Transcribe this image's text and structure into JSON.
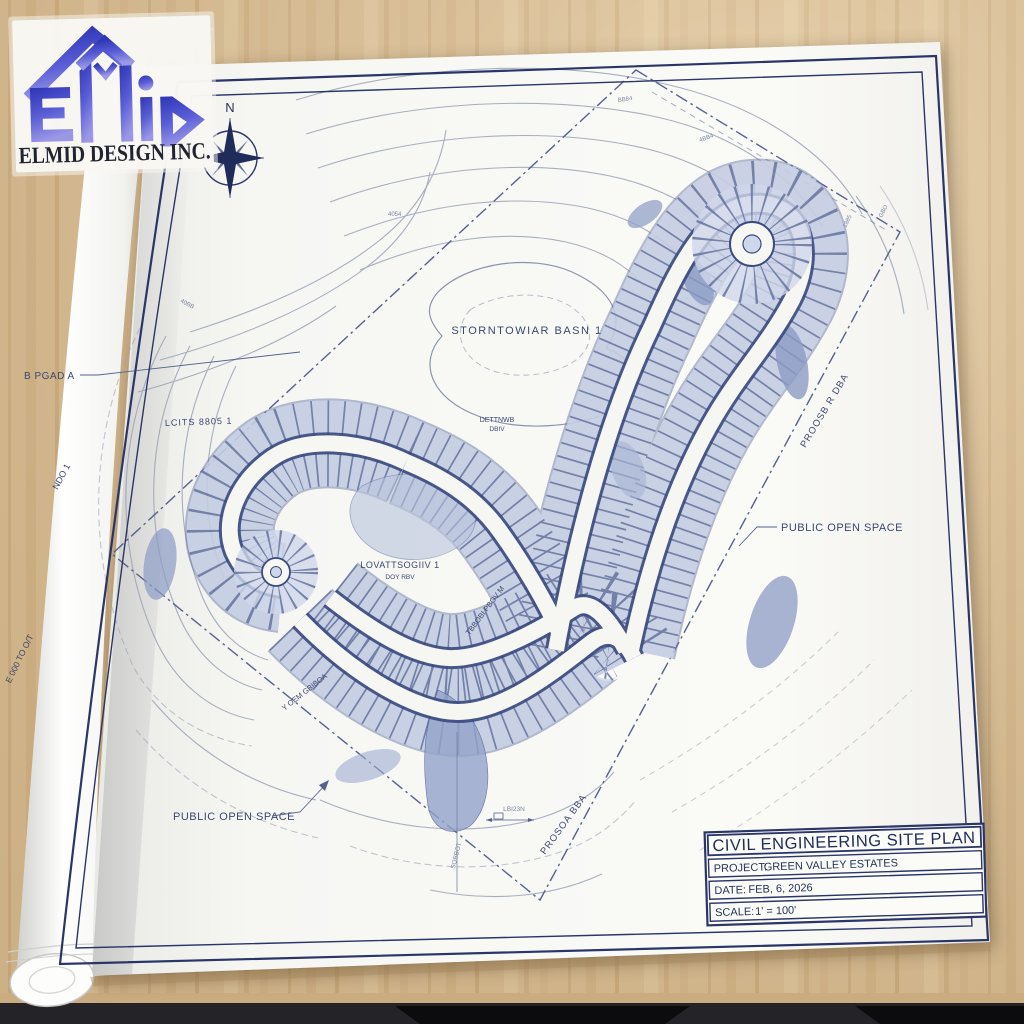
{
  "logo": {
    "company": "ELMID DESIGN INC."
  },
  "compass": {
    "north_label": "N"
  },
  "title_block": {
    "title": "CIVIL ENGINEERING SITE PLAN",
    "project_label": "PROJECT:",
    "project_value": "GREEN VALLEY ESTATES",
    "date_label": "DATE:",
    "date_value": "FEB, 6, 2026",
    "scale_label": "SCALE:",
    "scale_value": "1' = 100'"
  },
  "map_labels": {
    "basin": "STORNTOWIAR BASN 1",
    "basin_sub1": "DETTNWB",
    "basin_sub2": "DBIV",
    "lots_left": "LCITS 8805 1",
    "lots_center": "LOVATTSOGIIV 1",
    "lots_center_sub": "DOY RBV",
    "open_space_right": "PUBLIC OPEN SPACE",
    "open_space_left": "PUBLIC OPEN SPACE",
    "road_left": "B PGAD A",
    "road_right": "PROOSB R DBA",
    "road_bottom": "PROSOA BBA",
    "road_corridor": "TBBOBI PBOV M",
    "road_band": "Y OEM GBIBOA",
    "edge_left_1": "NDO 1",
    "edge_left_2": "E 000 TO O/T",
    "tiny_1": "LBI23N",
    "tiny_2": "SOBBOT"
  },
  "contour_marks": [
    "4054",
    "BB84",
    "4BB4",
    "40BB",
    "1885",
    "GBO"
  ],
  "colors": {
    "ink": "#2a3568",
    "contour": "#9aa2b6",
    "lot_band": "#cfd7ea",
    "lot_tick": "#5f6d99",
    "road_edge": "#3a4a7e",
    "veg_blob": "#8b9bc4",
    "wood": "#d9bd92",
    "logo_blue": "#3b41c4"
  }
}
